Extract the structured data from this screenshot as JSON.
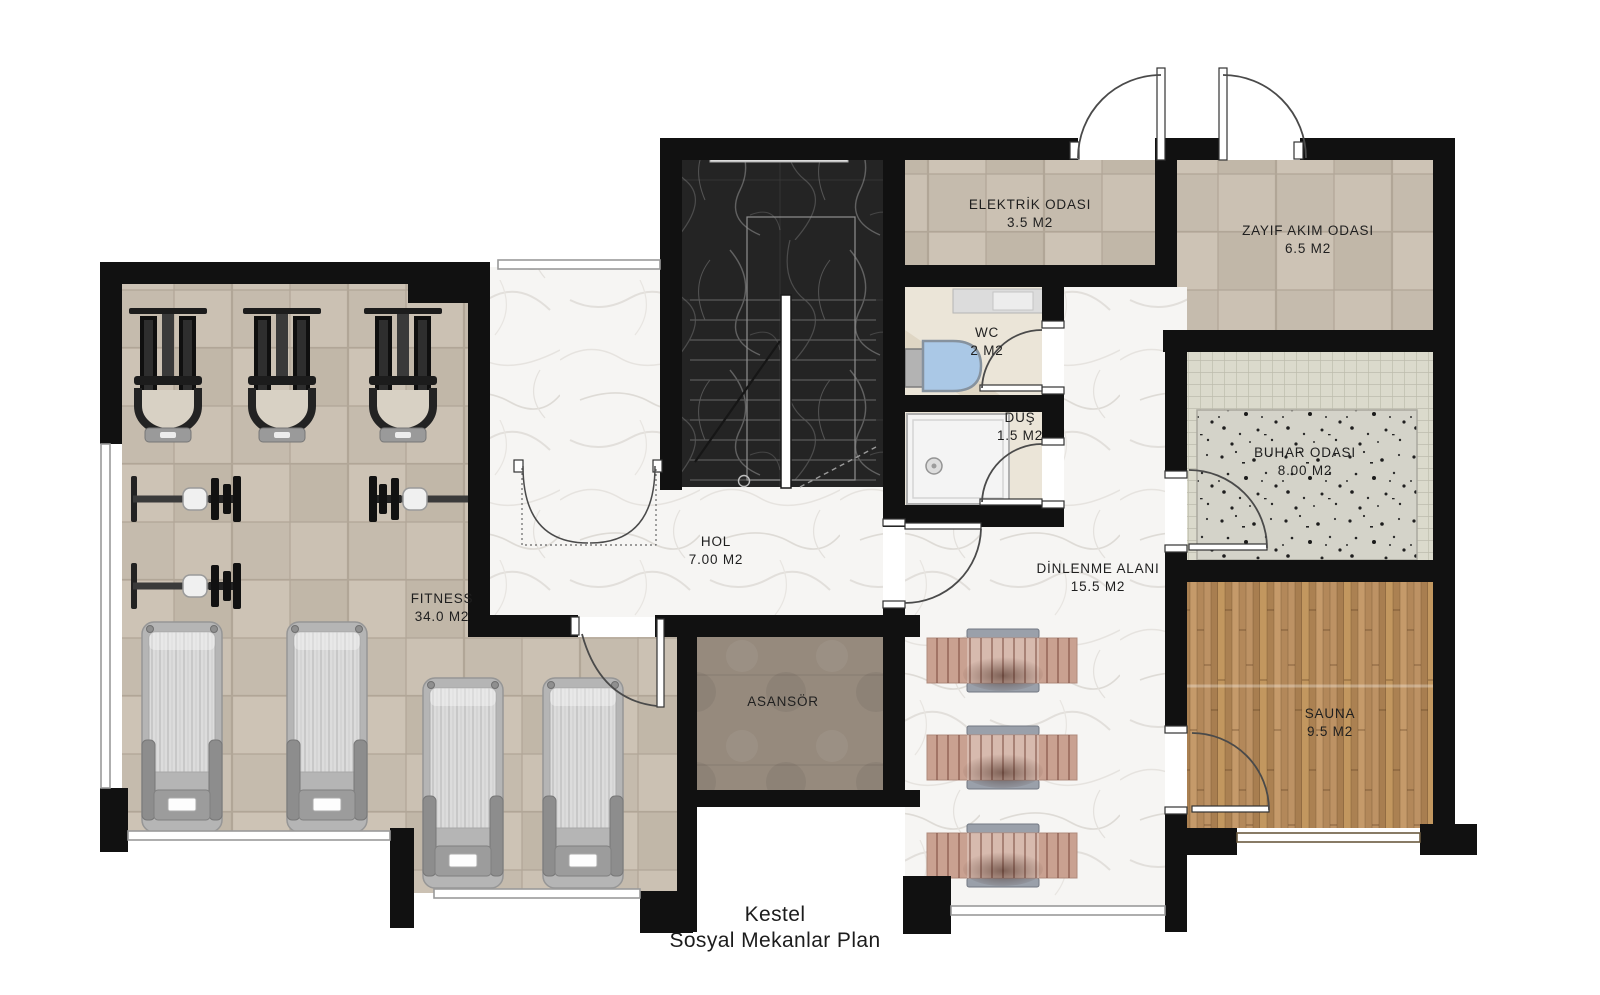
{
  "title": {
    "line1": "Kestel",
    "line2": "Sosyal Mekanlar Plan"
  },
  "rooms": [
    {
      "id": "fitness",
      "name": "FITNESS",
      "area": "34.0 M2"
    },
    {
      "id": "hol",
      "name": "HOL",
      "area": "7.00 M2"
    },
    {
      "id": "asansor",
      "name": "ASANSÖR",
      "area": ""
    },
    {
      "id": "elektrik",
      "name": "ELEKTRİK ODASI",
      "area": "3.5 M2"
    },
    {
      "id": "zayif",
      "name": "ZAYIF AKIM ODASI",
      "area": "6.5 M2"
    },
    {
      "id": "wc",
      "name": "WC",
      "area": "2 M2"
    },
    {
      "id": "dus",
      "name": "DUŞ",
      "area": "1.5 M2"
    },
    {
      "id": "buhar",
      "name": "BUHAR ODASI",
      "area": "8.00 M2"
    },
    {
      "id": "dinlenme",
      "name": "DİNLENME ALANI",
      "area": "15.5 M2"
    },
    {
      "id": "sauna",
      "name": "SAUNA",
      "area": "9.5 M2"
    }
  ],
  "colors": {
    "wall": "#111111",
    "beige_tile_floor": "#c6bcae",
    "marble_light_floor": "#f5f4f2",
    "marble_dark_stairs": "#232323",
    "sauna_wood": "#b98e60",
    "elevator_floor": "#968a7d",
    "lounger_wood": "#c9a191",
    "toilet_blue": "#aac8e6",
    "terrazzo": "#d4d3c9",
    "buhar_tile": "#dbdacc",
    "window_line": "#9a9a9a"
  },
  "fixtures": {
    "gym_machines": 3,
    "exercise_bikes": 3,
    "treadmills": 4,
    "loungers": 3,
    "toilet": 1,
    "shower_tray": 1,
    "entrance_doors_top": 2
  }
}
